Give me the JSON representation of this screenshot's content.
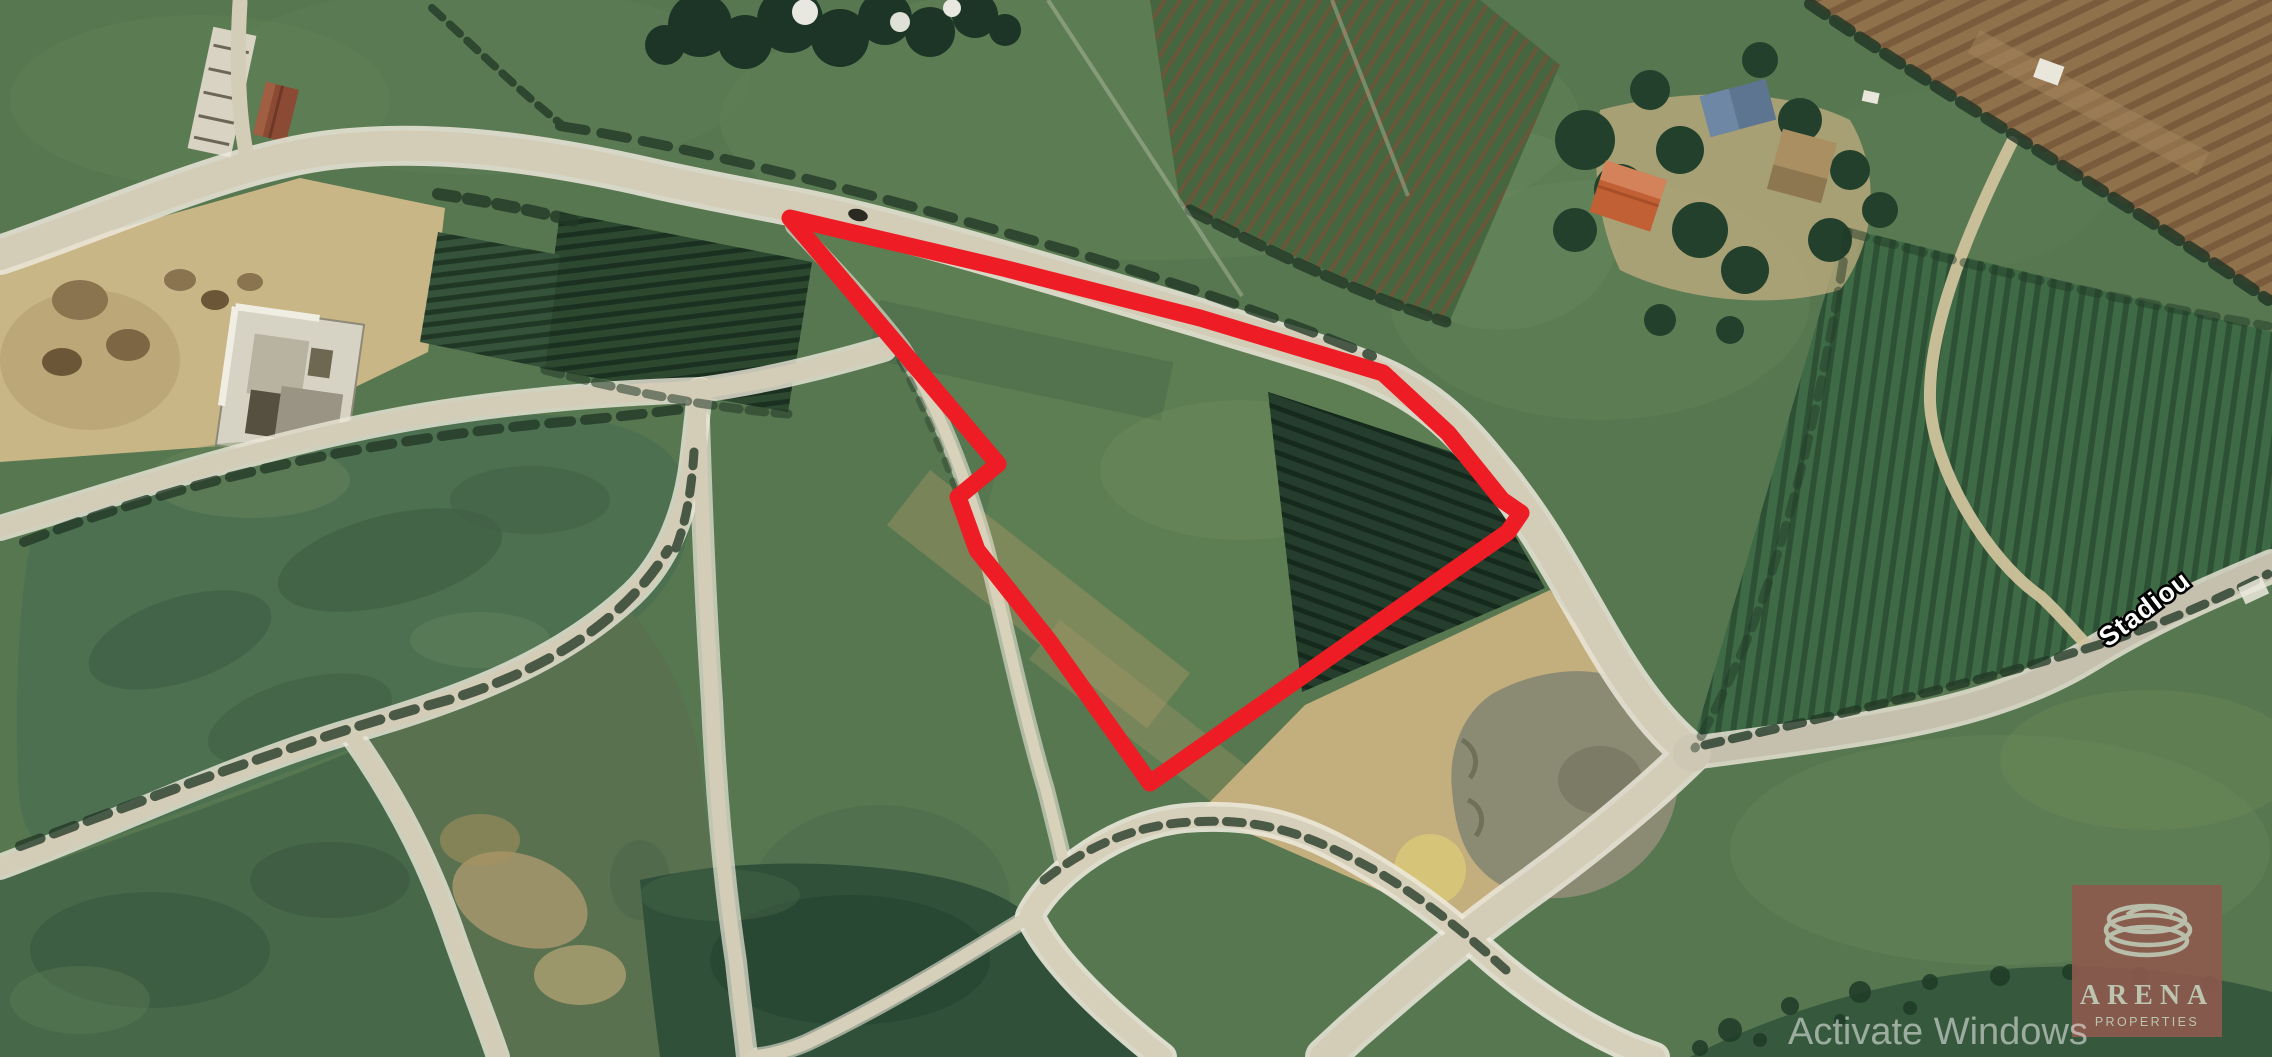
{
  "map": {
    "kind": "satellite-aerial-view",
    "street_label": "Stadiou",
    "palette": {
      "pasture_green": "#577750",
      "dark_field_green": "#30503a",
      "road_tan": "#d3ccb7",
      "road_paved": "#c5bfae",
      "dirt_tan": "#c9b686",
      "orchard_dark": "#243d2c",
      "boundary_red": "#ee1c24"
    }
  },
  "overlay": {
    "boundary": {
      "label": "plot-outline",
      "color": "#ee1c24",
      "stroke_width": 17,
      "points": [
        [
          790,
          218
        ],
        [
          1003,
          268
        ],
        [
          1200,
          318
        ],
        [
          1383,
          373
        ],
        [
          1448,
          433
        ],
        [
          1502,
          500
        ],
        [
          1521,
          513
        ],
        [
          1508,
          532
        ],
        [
          1150,
          783
        ],
        [
          1050,
          642
        ],
        [
          977,
          550
        ],
        [
          958,
          497
        ],
        [
          998,
          464
        ]
      ]
    }
  },
  "branding": {
    "name": "ARENA",
    "subtitle": "PROPERTIES",
    "panel_color": "#8e5a4c",
    "text_color": "#bcc4b0"
  },
  "watermark": {
    "text": "Activate Windows",
    "color": "#f0f2f0"
  }
}
